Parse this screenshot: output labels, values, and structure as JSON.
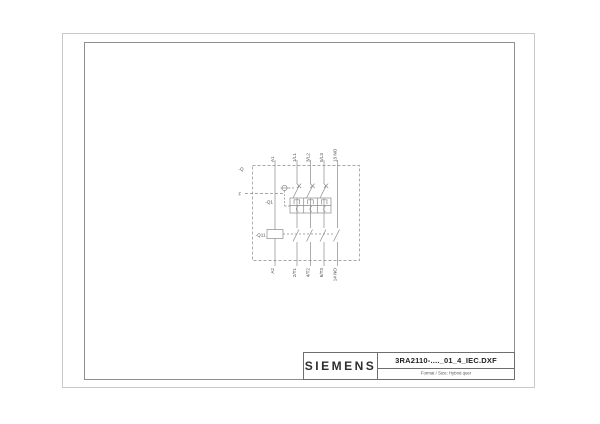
{
  "page": {
    "background": "#ffffff"
  },
  "titleblock": {
    "brand": "SIEMENS",
    "drawing_name": "3RA2110-...._01_4_IEC.DXF",
    "format_line": "Format / Size: Hybrid quer"
  },
  "schematic": {
    "tags": {
      "enclosure": "-Q",
      "release": "F",
      "breaker": "-Q1",
      "contactor": "-Q11"
    },
    "top_terminals": [
      "A1",
      "1/L1",
      "3/L2",
      "5/L3",
      "13 NO"
    ],
    "bottom_terminals": [
      "A2",
      "2/T1",
      "4/T2",
      "6/T3",
      "14 NO"
    ],
    "colors": {
      "line": "#8a8a8a",
      "label": "#4d4d4d",
      "frame_outer": "#c9c9c9",
      "frame_inner": "#8f8f8f",
      "titleblock_border": "#6e6e6e"
    }
  }
}
